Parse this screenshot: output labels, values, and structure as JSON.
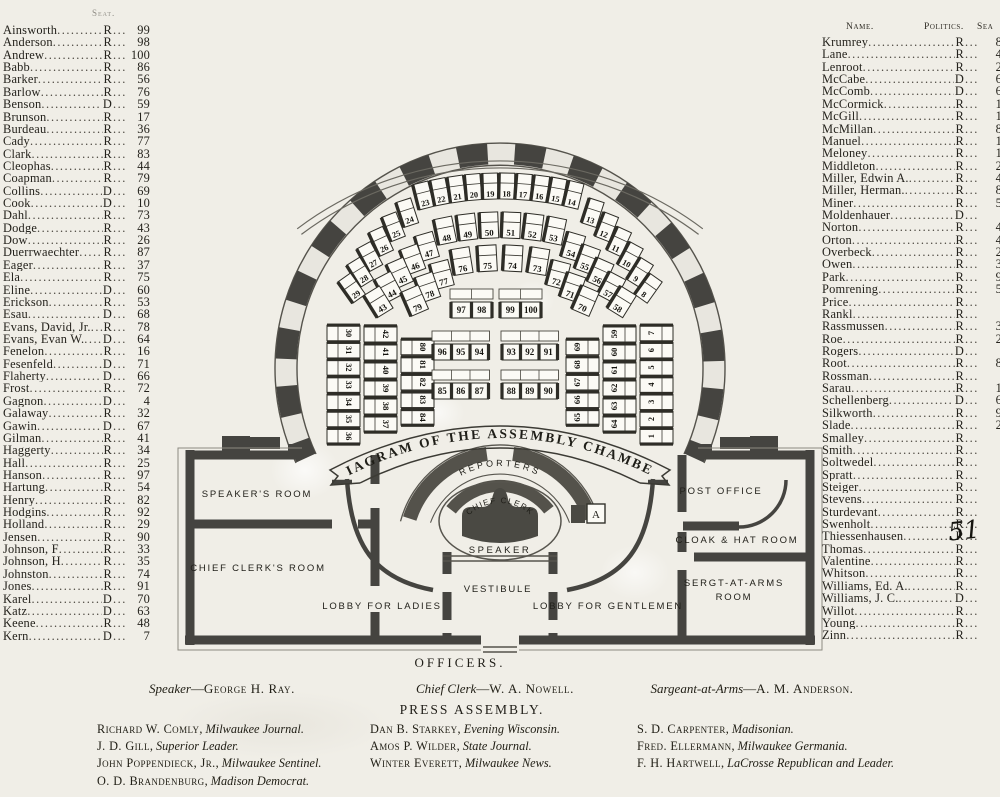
{
  "colors": {
    "paper": "#f0eee7",
    "ink": "#24221c",
    "wall": "#454440",
    "seat_fill": "#fbfaf5"
  },
  "lists": {
    "left": {
      "header_partial": "Seat.",
      "rows": [
        {
          "name": "Ainsworth",
          "party": "R",
          "seat": "99"
        },
        {
          "name": "Anderson",
          "party": "R",
          "seat": "98"
        },
        {
          "name": "Andrew",
          "party": "R",
          "seat": "100"
        },
        {
          "name": "Babb",
          "party": "R",
          "seat": "86"
        },
        {
          "name": "Barker",
          "party": "R",
          "seat": "56"
        },
        {
          "name": "Barlow",
          "party": "R",
          "seat": "76"
        },
        {
          "name": "Benson",
          "party": "D",
          "seat": "59"
        },
        {
          "name": "Brunson",
          "party": "R",
          "seat": "17"
        },
        {
          "name": "Burdeau",
          "party": "R",
          "seat": "36"
        },
        {
          "name": "Cady",
          "party": "R",
          "seat": "77"
        },
        {
          "name": "Clark",
          "party": "R",
          "seat": "83"
        },
        {
          "name": "Cleophas",
          "party": "R",
          "seat": "44"
        },
        {
          "name": "Coapman",
          "party": "R",
          "seat": "79"
        },
        {
          "name": "Collins",
          "party": "D",
          "seat": "69"
        },
        {
          "name": "Cook",
          "party": "D",
          "seat": "10"
        },
        {
          "name": "Dahl",
          "party": "R",
          "seat": "73"
        },
        {
          "name": "Dodge",
          "party": "R",
          "seat": "43"
        },
        {
          "name": "Dow",
          "party": "R",
          "seat": "26"
        },
        {
          "name": "Duerrwaechter",
          "party": "R",
          "seat": "87"
        },
        {
          "name": "Eager",
          "party": "R",
          "seat": "37"
        },
        {
          "name": "Ela",
          "party": "R",
          "seat": "75"
        },
        {
          "name": "Eline",
          "party": "D",
          "seat": "60"
        },
        {
          "name": "Erickson",
          "party": "R",
          "seat": "53"
        },
        {
          "name": "Esau",
          "party": "D",
          "seat": "68"
        },
        {
          "name": "Evans, David, Jr.",
          "party": "R",
          "seat": "78"
        },
        {
          "name": "Evans, Evan W.",
          "party": "D",
          "seat": "64"
        },
        {
          "name": "Fenelon",
          "party": "R",
          "seat": "16"
        },
        {
          "name": "Fesenfeld",
          "party": "D",
          "seat": "71"
        },
        {
          "name": "Flaherty",
          "party": "D",
          "seat": "66"
        },
        {
          "name": "Frost",
          "party": "R",
          "seat": "72"
        },
        {
          "name": "Gagnon",
          "party": "D",
          "seat": "4"
        },
        {
          "name": "Galaway",
          "party": "R",
          "seat": "32"
        },
        {
          "name": "Gawin",
          "party": "D",
          "seat": "67"
        },
        {
          "name": "Gilman",
          "party": "R",
          "seat": "41"
        },
        {
          "name": "Haggerty",
          "party": "R",
          "seat": "34"
        },
        {
          "name": "Hall",
          "party": "R",
          "seat": "25"
        },
        {
          "name": "Hanson",
          "party": "R",
          "seat": "97"
        },
        {
          "name": "Hartung",
          "party": "R",
          "seat": "54"
        },
        {
          "name": "Henry",
          "party": "R",
          "seat": "82"
        },
        {
          "name": "Hodgins",
          "party": "R",
          "seat": "92"
        },
        {
          "name": "Holland",
          "party": "R",
          "seat": "29"
        },
        {
          "name": "Jensen",
          "party": "R",
          "seat": "90"
        },
        {
          "name": "Johnson, F",
          "party": "R",
          "seat": "33"
        },
        {
          "name": "Johnson, H",
          "party": "R",
          "seat": "35"
        },
        {
          "name": "Johnston",
          "party": "R",
          "seat": "74"
        },
        {
          "name": "Jones",
          "party": "R",
          "seat": "91"
        },
        {
          "name": "Karel",
          "party": "D",
          "seat": "70"
        },
        {
          "name": "Katz",
          "party": "D",
          "seat": "63"
        },
        {
          "name": "Keene",
          "party": "R",
          "seat": "48"
        },
        {
          "name": "Kern",
          "party": "D",
          "seat": "7"
        }
      ]
    },
    "right": {
      "header": {
        "name": "Name.",
        "politics": "Politics.",
        "seat": "Sea"
      },
      "annotation": "51",
      "rows": [
        {
          "name": "Krumrey",
          "party": "R",
          "seat": "8"
        },
        {
          "name": "Lane",
          "party": "R",
          "seat": "4"
        },
        {
          "name": "Lenroot",
          "party": "R",
          "seat": "2"
        },
        {
          "name": "McCabe",
          "party": "D",
          "seat": "6"
        },
        {
          "name": "McComb",
          "party": "D",
          "seat": "6"
        },
        {
          "name": "McCormick",
          "party": "R",
          "seat": "1"
        },
        {
          "name": "McGill",
          "party": "R",
          "seat": "1"
        },
        {
          "name": "McMillan",
          "party": "R",
          "seat": "8"
        },
        {
          "name": "Manuel",
          "party": "R",
          "seat": "1"
        },
        {
          "name": "Meloney",
          "party": "R",
          "seat": "1"
        },
        {
          "name": "Middleton",
          "party": "R",
          "seat": "2"
        },
        {
          "name": "Miller, Edwin A.",
          "party": "R",
          "seat": "4"
        },
        {
          "name": "Miller, Herman.",
          "party": "R",
          "seat": "8"
        },
        {
          "name": "Miner",
          "party": "R",
          "seat": "5"
        },
        {
          "name": "Moldenhauer",
          "party": "D",
          "seat": ""
        },
        {
          "name": "Norton",
          "party": "R",
          "seat": "4"
        },
        {
          "name": "Orton",
          "party": "R",
          "seat": "4"
        },
        {
          "name": "Overbeck",
          "party": "R",
          "seat": "2"
        },
        {
          "name": "Owen",
          "party": "R",
          "seat": "3"
        },
        {
          "name": "Park",
          "party": "R",
          "seat": "9"
        },
        {
          "name": "Pomrening",
          "party": "R",
          "seat": "5"
        },
        {
          "name": "Price",
          "party": "R",
          "seat": ""
        },
        {
          "name": "Rankl",
          "party": "R",
          "seat": ""
        },
        {
          "name": "Rassmussen",
          "party": "R",
          "seat": "3"
        },
        {
          "name": "Roe",
          "party": "R",
          "seat": "2"
        },
        {
          "name": "Rogers",
          "party": "D",
          "seat": ""
        },
        {
          "name": "Root",
          "party": "R",
          "seat": "8"
        },
        {
          "name": "Rossman",
          "party": "R",
          "seat": ""
        },
        {
          "name": "Sarau",
          "party": "R",
          "seat": "1"
        },
        {
          "name": "Schellenberg",
          "party": "D",
          "seat": "6"
        },
        {
          "name": "Silkworth",
          "party": "R",
          "seat": "9"
        },
        {
          "name": "Slade",
          "party": "R",
          "seat": "2"
        },
        {
          "name": "Smalley",
          "party": "R",
          "seat": ""
        },
        {
          "name": "Smith",
          "party": "R",
          "seat": ""
        },
        {
          "name": "Soltwedel",
          "party": "R",
          "seat": ""
        },
        {
          "name": "Spratt",
          "party": "R",
          "seat": ""
        },
        {
          "name": "Steiger",
          "party": "R",
          "seat": ""
        },
        {
          "name": "Stevens",
          "party": "R",
          "seat": ""
        },
        {
          "name": "Sturdevant",
          "party": "R",
          "seat": ""
        },
        {
          "name": "Swenholt",
          "party": "R",
          "seat": ""
        },
        {
          "name": "Thiessenhausen",
          "party": "R",
          "seat": ""
        },
        {
          "name": "Thomas",
          "party": "R",
          "seat": ""
        },
        {
          "name": "Valentine",
          "party": "R",
          "seat": ""
        },
        {
          "name": "Whitson",
          "party": "R",
          "seat": ""
        },
        {
          "name": "Williams, Ed. A.",
          "party": "R",
          "seat": ""
        },
        {
          "name": "Williams, J. C.",
          "party": "D",
          "seat": ""
        },
        {
          "name": "Willot",
          "party": "R",
          "seat": ""
        },
        {
          "name": "Young",
          "party": "R",
          "seat": ""
        },
        {
          "name": "Zinn",
          "party": "R",
          "seat": ""
        }
      ]
    }
  },
  "diagram": {
    "banner": "DIAGRAM OF THE ASSEMBLY CHAMBER",
    "labels": {
      "reporters": "REPORTERS",
      "chief_clerk": "CHIEF CLERK",
      "speaker": "SPEAKER",
      "marker_a": "A"
    },
    "rooms": {
      "speakers_room": "SPEAKER'S ROOM",
      "chief_clerks_room": "CHIEF CLERK'S ROOM",
      "lobby_ladies": "LOBBY FOR LADIES",
      "vestibule": "VESTIBULE",
      "lobby_gentlemen": "LOBBY FOR GENTLEMEN",
      "post_office": "POST OFFICE",
      "cloak_hat_room": "CLOAK & HAT ROOM",
      "sergt_room_line1": "SERGT-AT-ARMS",
      "sergt_room_line2": "ROOM"
    },
    "seating": {
      "rows": [
        {
          "left_column": [
            30,
            31,
            32,
            33,
            34,
            35,
            36
          ],
          "left_arc": [
            24,
            25,
            26,
            27,
            28,
            29
          ],
          "top_arc": [
            23,
            22,
            21,
            20,
            19,
            18,
            17,
            16,
            15,
            14
          ],
          "right_arc": [
            13,
            12,
            11,
            10,
            9,
            8
          ],
          "right_column": [
            7,
            6,
            5,
            4,
            3,
            2,
            1
          ]
        },
        {
          "left_column": [
            42,
            41,
            40,
            39,
            38,
            37
          ],
          "left_arc": [
            47,
            46,
            45,
            44,
            43
          ],
          "top_arc": [
            48,
            49,
            50,
            51,
            52,
            53
          ],
          "right_arc": [
            54,
            55,
            56,
            57,
            58
          ],
          "right_column": [
            59,
            60,
            61,
            62,
            63,
            64
          ]
        },
        {
          "left_column": [
            80,
            81,
            82,
            83,
            84
          ],
          "left_arc": [
            77,
            78,
            79
          ],
          "top_arc": [
            76,
            75,
            74,
            73
          ],
          "right_arc": [
            72,
            71,
            70
          ],
          "right_column": [
            69,
            68,
            67,
            66,
            65
          ]
        }
      ],
      "center_blocks": [
        {
          "blocks": [
            [
              97,
              98
            ],
            [
              99,
              100
            ]
          ]
        },
        {
          "blocks": [
            [
              96,
              95,
              94
            ],
            [
              93,
              92,
              91
            ]
          ]
        },
        {
          "blocks": [
            [
              85,
              86,
              87
            ],
            [
              88,
              89,
              90
            ]
          ]
        }
      ]
    }
  },
  "footer": {
    "officers_title": "OFFICERS.",
    "officers": [
      {
        "role": "Speaker",
        "name": "George H. Ray."
      },
      {
        "role": "Chief Clerk",
        "name": "W. A. Nowell."
      },
      {
        "role": "Sargeant-at-Arms",
        "name": "A. M. Anderson."
      }
    ],
    "press_title": "PRESS ASSEMBLY.",
    "press_columns": [
      [
        {
          "name": "Richard W. Comly",
          "paper": "Milwaukee Journal."
        },
        {
          "name": "J. D. Gill",
          "paper": "Superior Leader."
        },
        {
          "name": "John Poppendieck, Jr.",
          "paper": "Milwaukee Sentinel."
        },
        {
          "name": "O. D. Brandenburg",
          "paper": "Madison Democrat."
        }
      ],
      [
        {
          "name": "Dan B. Starkey",
          "paper": "Evening Wisconsin."
        },
        {
          "name": "Amos P. Wilder",
          "paper": "State Journal."
        },
        {
          "name": "Winter Everett",
          "paper": "Milwaukee News."
        }
      ],
      [
        {
          "name": "S. D. Carpenter",
          "paper": "Madisonian."
        },
        {
          "name": "Fred. Ellermann",
          "paper": "Milwaukee Germania."
        },
        {
          "name": "F. H. Hartwell",
          "paper": "LaCrosse Republican and Leader."
        }
      ]
    ]
  }
}
